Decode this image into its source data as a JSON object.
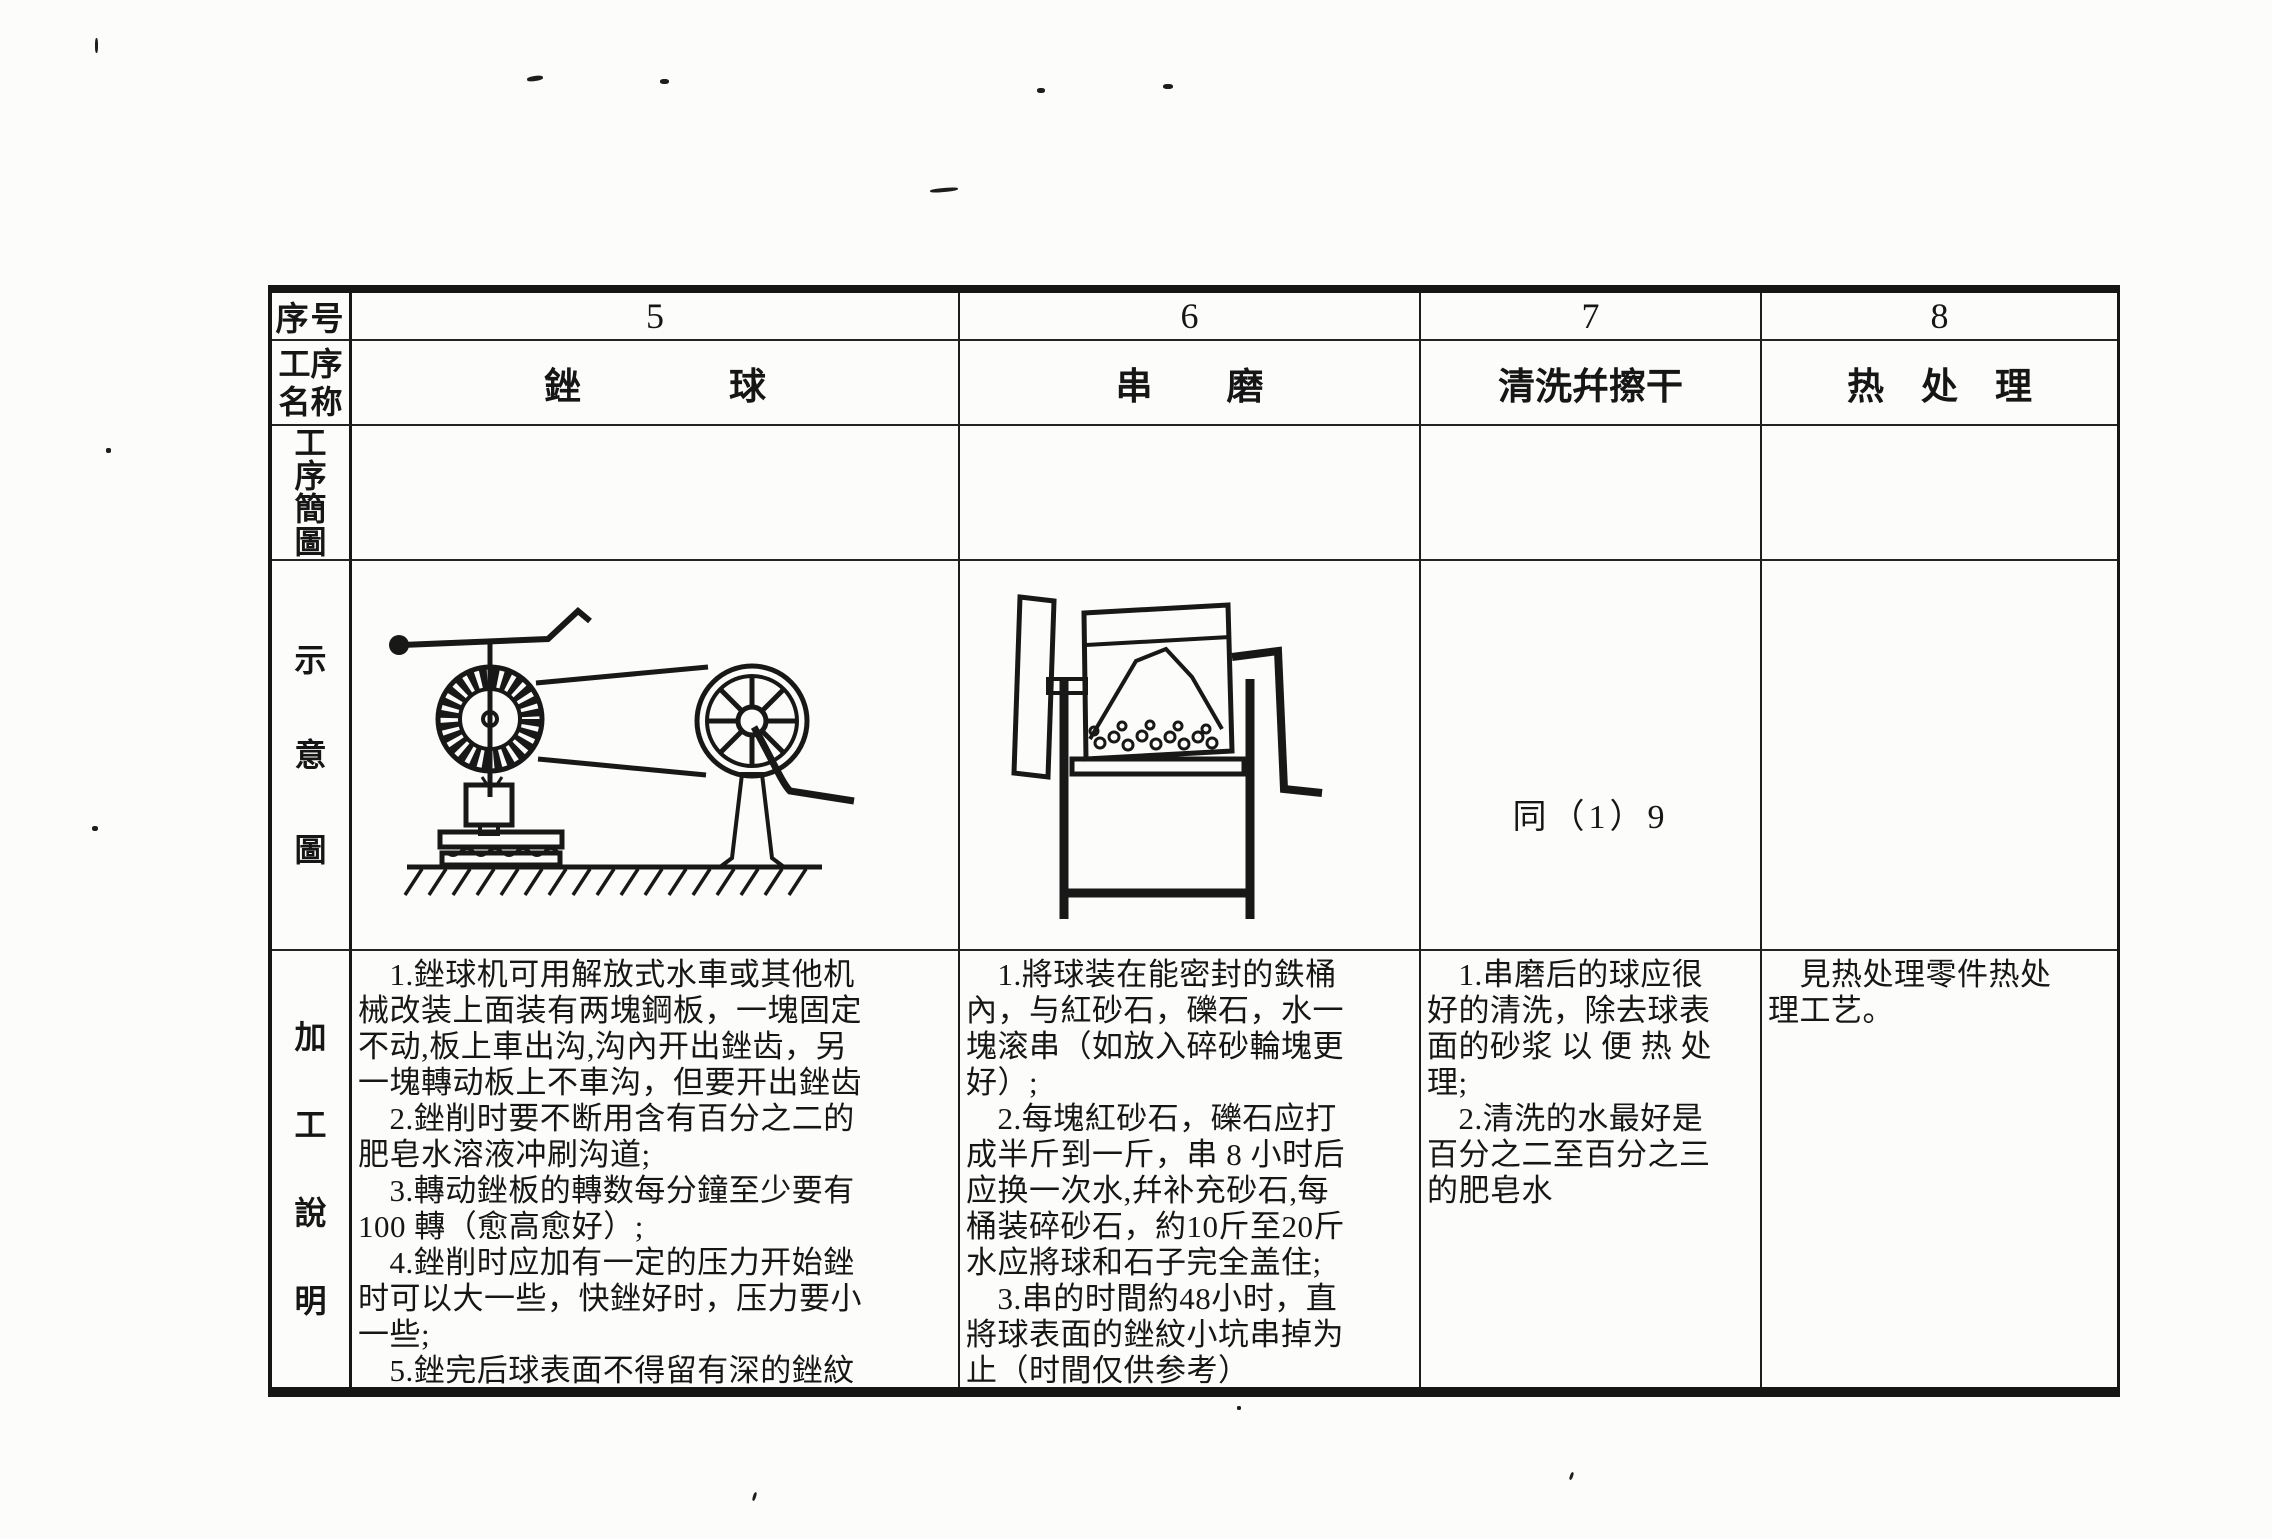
{
  "table": {
    "row_labels": {
      "seq": "序号",
      "name": "工序名称",
      "sketch": "工序簡圖",
      "diagram": "示意圖",
      "notes": "加工說明"
    },
    "columns": [
      {
        "number": "5",
        "name": "銼　　　　球"
      },
      {
        "number": "6",
        "name": "串　　磨"
      },
      {
        "number": "7",
        "name": "清洗幷擦干"
      },
      {
        "number": "8",
        "name": "热　处　理"
      }
    ],
    "diagram_row": {
      "col5_diagram": "ball-filing-machine",
      "col6_diagram": "tumbling-drum",
      "col7_note": "同（1）9"
    },
    "notes": {
      "col5": [
        "　1.銼球机可用解放式水車或其他机",
        "械改装上面装有两塊鋼板，一塊固定",
        "不动,板上車出沟,沟內开出銼齿，另",
        "一塊轉动板上不車沟，但要开出銼齿",
        "　2.銼削时要不断用含有百分之二的",
        "肥皂水溶液冲刷沟道;",
        "　3.轉动銼板的轉数每分鐘至少要有",
        "100 轉（愈高愈好）;",
        "　4.銼削时应加有一定的压力开始銼",
        "时可以大一些，快銼好时，压力要小",
        "一些;",
        "　5.銼完后球表面不得留有深的銼紋"
      ],
      "col6": [
        "　1.將球装在能密封的鉄桶",
        "內，与紅砂石，礫石，水一",
        "塊滚串（如放入碎砂輪塊更",
        "好）;",
        "　2.每塊紅砂石，礫石应打",
        "成半斤到一斤，串 8 小时后",
        "应换一次水,幷补充砂石,每",
        "桶装碎砂石，約10斤至20斤",
        "水应將球和石子完全盖住;",
        "　3.串的时間約48小时，直",
        "將球表面的銼紋小坑串掉为",
        "止（时間仅供参考）"
      ],
      "col7": [
        "　1.串磨后的球应很",
        "好的清洗，除去球表",
        "面的砂浆 以 便 热 处",
        "理;",
        "　2.清洗的水最好是",
        "百分之二至百分之三",
        "的肥皂水"
      ],
      "col8": [
        "　見热处理零件热处",
        "理工艺。"
      ]
    }
  },
  "colors": {
    "ink": "#161616",
    "paper": "#fcfcfa"
  }
}
